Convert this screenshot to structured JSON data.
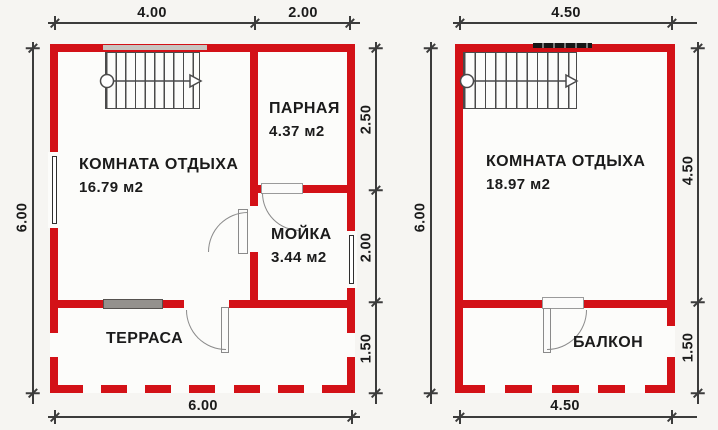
{
  "title": "Bathhouse floor plans (1st floor and 2nd floor)",
  "colors": {
    "wall_red": "#d31117",
    "dimension_line": "#3c3c3c",
    "text": "#1b1b1b",
    "window_gray": "#94918d",
    "background": "#f6f5f2"
  },
  "plan_left": {
    "dim_top": [
      "4.00",
      "2.00"
    ],
    "dim_left": "6.00",
    "dim_right": [
      "2.50",
      "2.00",
      "1.50"
    ],
    "dim_bottom": "6.00",
    "rooms": {
      "rest": {
        "name": "КОМНАТА ОТДЫХА",
        "area": "16.79 м2"
      },
      "steam": {
        "name": "ПАРНАЯ",
        "area": "4.37 м2"
      },
      "wash": {
        "name": "МОЙКА",
        "area": "3.44 м2"
      },
      "terrace": {
        "name": "ТЕРРАСА"
      }
    }
  },
  "plan_right": {
    "dim_top": "4.50",
    "dim_left": "6.00",
    "dim_right": [
      "4.50",
      "1.50"
    ],
    "dim_bottom": "4.50",
    "rooms": {
      "rest": {
        "name": "КОМНАТА ОТДЫХА",
        "area": "18.97 м2"
      },
      "balcony": {
        "name": "БАЛКОН"
      }
    }
  }
}
